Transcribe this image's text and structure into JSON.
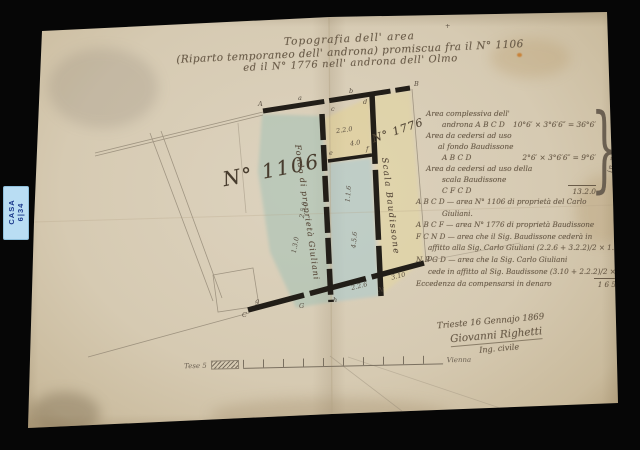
{
  "photo": {
    "archive_label": {
      "line1": "CASA",
      "line2": "6|34"
    }
  },
  "title": {
    "line1": "Topografia dell' area",
    "line2": "(Riparto temporaneo dell' androna) promiscua fra il N° 1106",
    "line3": "ed il N° 1776 nell' androna dell' Olmo"
  },
  "map": {
    "parcel_left_label": "N° 1106",
    "parcel_right_label": "N° 1776",
    "street_label": "Scala Baudissone",
    "boundary_label": "Fondo di proprietà Giuliani",
    "marks": [
      {
        "t": "+",
        "x": 445,
        "y": 22
      },
      {
        "t": "A",
        "x": 258,
        "y": 100
      },
      {
        "t": "a",
        "x": 298,
        "y": 94
      },
      {
        "t": "b",
        "x": 349,
        "y": 87
      },
      {
        "t": "B",
        "x": 414,
        "y": 80
      },
      {
        "t": "c",
        "x": 331,
        "y": 105
      },
      {
        "t": "d",
        "x": 363,
        "y": 98
      },
      {
        "t": "2.2.0",
        "x": 336,
        "y": 126,
        "r": -8
      },
      {
        "t": "4.0",
        "x": 350,
        "y": 139,
        "r": -8
      },
      {
        "t": "e",
        "x": 329,
        "y": 149
      },
      {
        "t": "f",
        "x": 366,
        "y": 145
      },
      {
        "t": "1.1.6",
        "x": 340,
        "y": 190,
        "r": -85
      },
      {
        "t": "4.5.6",
        "x": 346,
        "y": 236,
        "r": -85
      },
      {
        "t": "2.5.0",
        "x": 295,
        "y": 206,
        "r": -80
      },
      {
        "t": "1.3.0",
        "x": 287,
        "y": 241,
        "r": -80
      },
      {
        "t": "2.2.6",
        "x": 351,
        "y": 282,
        "r": -14
      },
      {
        "t": "3.10",
        "x": 391,
        "y": 272,
        "r": -14
      },
      {
        "t": "g",
        "x": 255,
        "y": 297
      },
      {
        "t": "C",
        "x": 242,
        "y": 311
      },
      {
        "t": "G",
        "x": 299,
        "y": 302
      },
      {
        "t": "h",
        "x": 333,
        "y": 296
      },
      {
        "t": "N",
        "x": 378,
        "y": 286
      },
      {
        "t": "D",
        "x": 427,
        "y": 255
      }
    ]
  },
  "notes_upper": {
    "rows": [
      {
        "t": "Area complessiva dell'",
        "v": ""
      },
      {
        "t": "androna A B C D",
        "v": "10°6′ × 3°6′6″ = 36°6′"
      },
      {
        "t": "Area da cedersi ad uso",
        "v": ""
      },
      {
        "t": "al fondo Baudissone",
        "v": ""
      },
      {
        "t": "A B C D",
        "v": "2°6′ × 3°6′6″ = 9°6′"
      },
      {
        "t": "Area da cedersi ad uso della",
        "v": ""
      },
      {
        "t": "scala Baudissone",
        "v": ""
      },
      {
        "t": "C F C D",
        "v": "13.2.0"
      }
    ],
    "brace_label": "in natura"
  },
  "notes_lower": {
    "rows": [
      {
        "t": "A B C D — area N° 1106 di proprietà del Carlo",
        "v": ""
      },
      {
        "t": "Giuliani.",
        "v": ""
      },
      {
        "t": "A B C F — area N° 1776 di proprietà Baudissone",
        "v": ""
      },
      {
        "t": "F C N D — area che il Sig. Baudissone cederà in",
        "v": ""
      },
      {
        "t": "affitto alla Sig. Carlo Giuliani (2.2.6 + 3.2.2)/2 × 1.3 =",
        "v": "18° 1′ 3¼″"
      },
      {
        "t": "N B G D — area che la Sig. Carlo Giuliani",
        "v": ""
      },
      {
        "t": "cede in affitto al Sig. Baudissone (3.10 + 2.2.2)/2 × 1.3 =",
        "v": "8° 1′ 10¾″"
      },
      {
        "t": "Eccedenza da compensarsi in denaro",
        "v": "1 6 5"
      }
    ]
  },
  "signature": {
    "place_date": "Trieste 16 Gennajo 1869",
    "name": "Giovanni Righetti",
    "role": "Ing. civile"
  },
  "scale_bar": {
    "left_label": "Tese 5",
    "right_label": "Vienna"
  }
}
